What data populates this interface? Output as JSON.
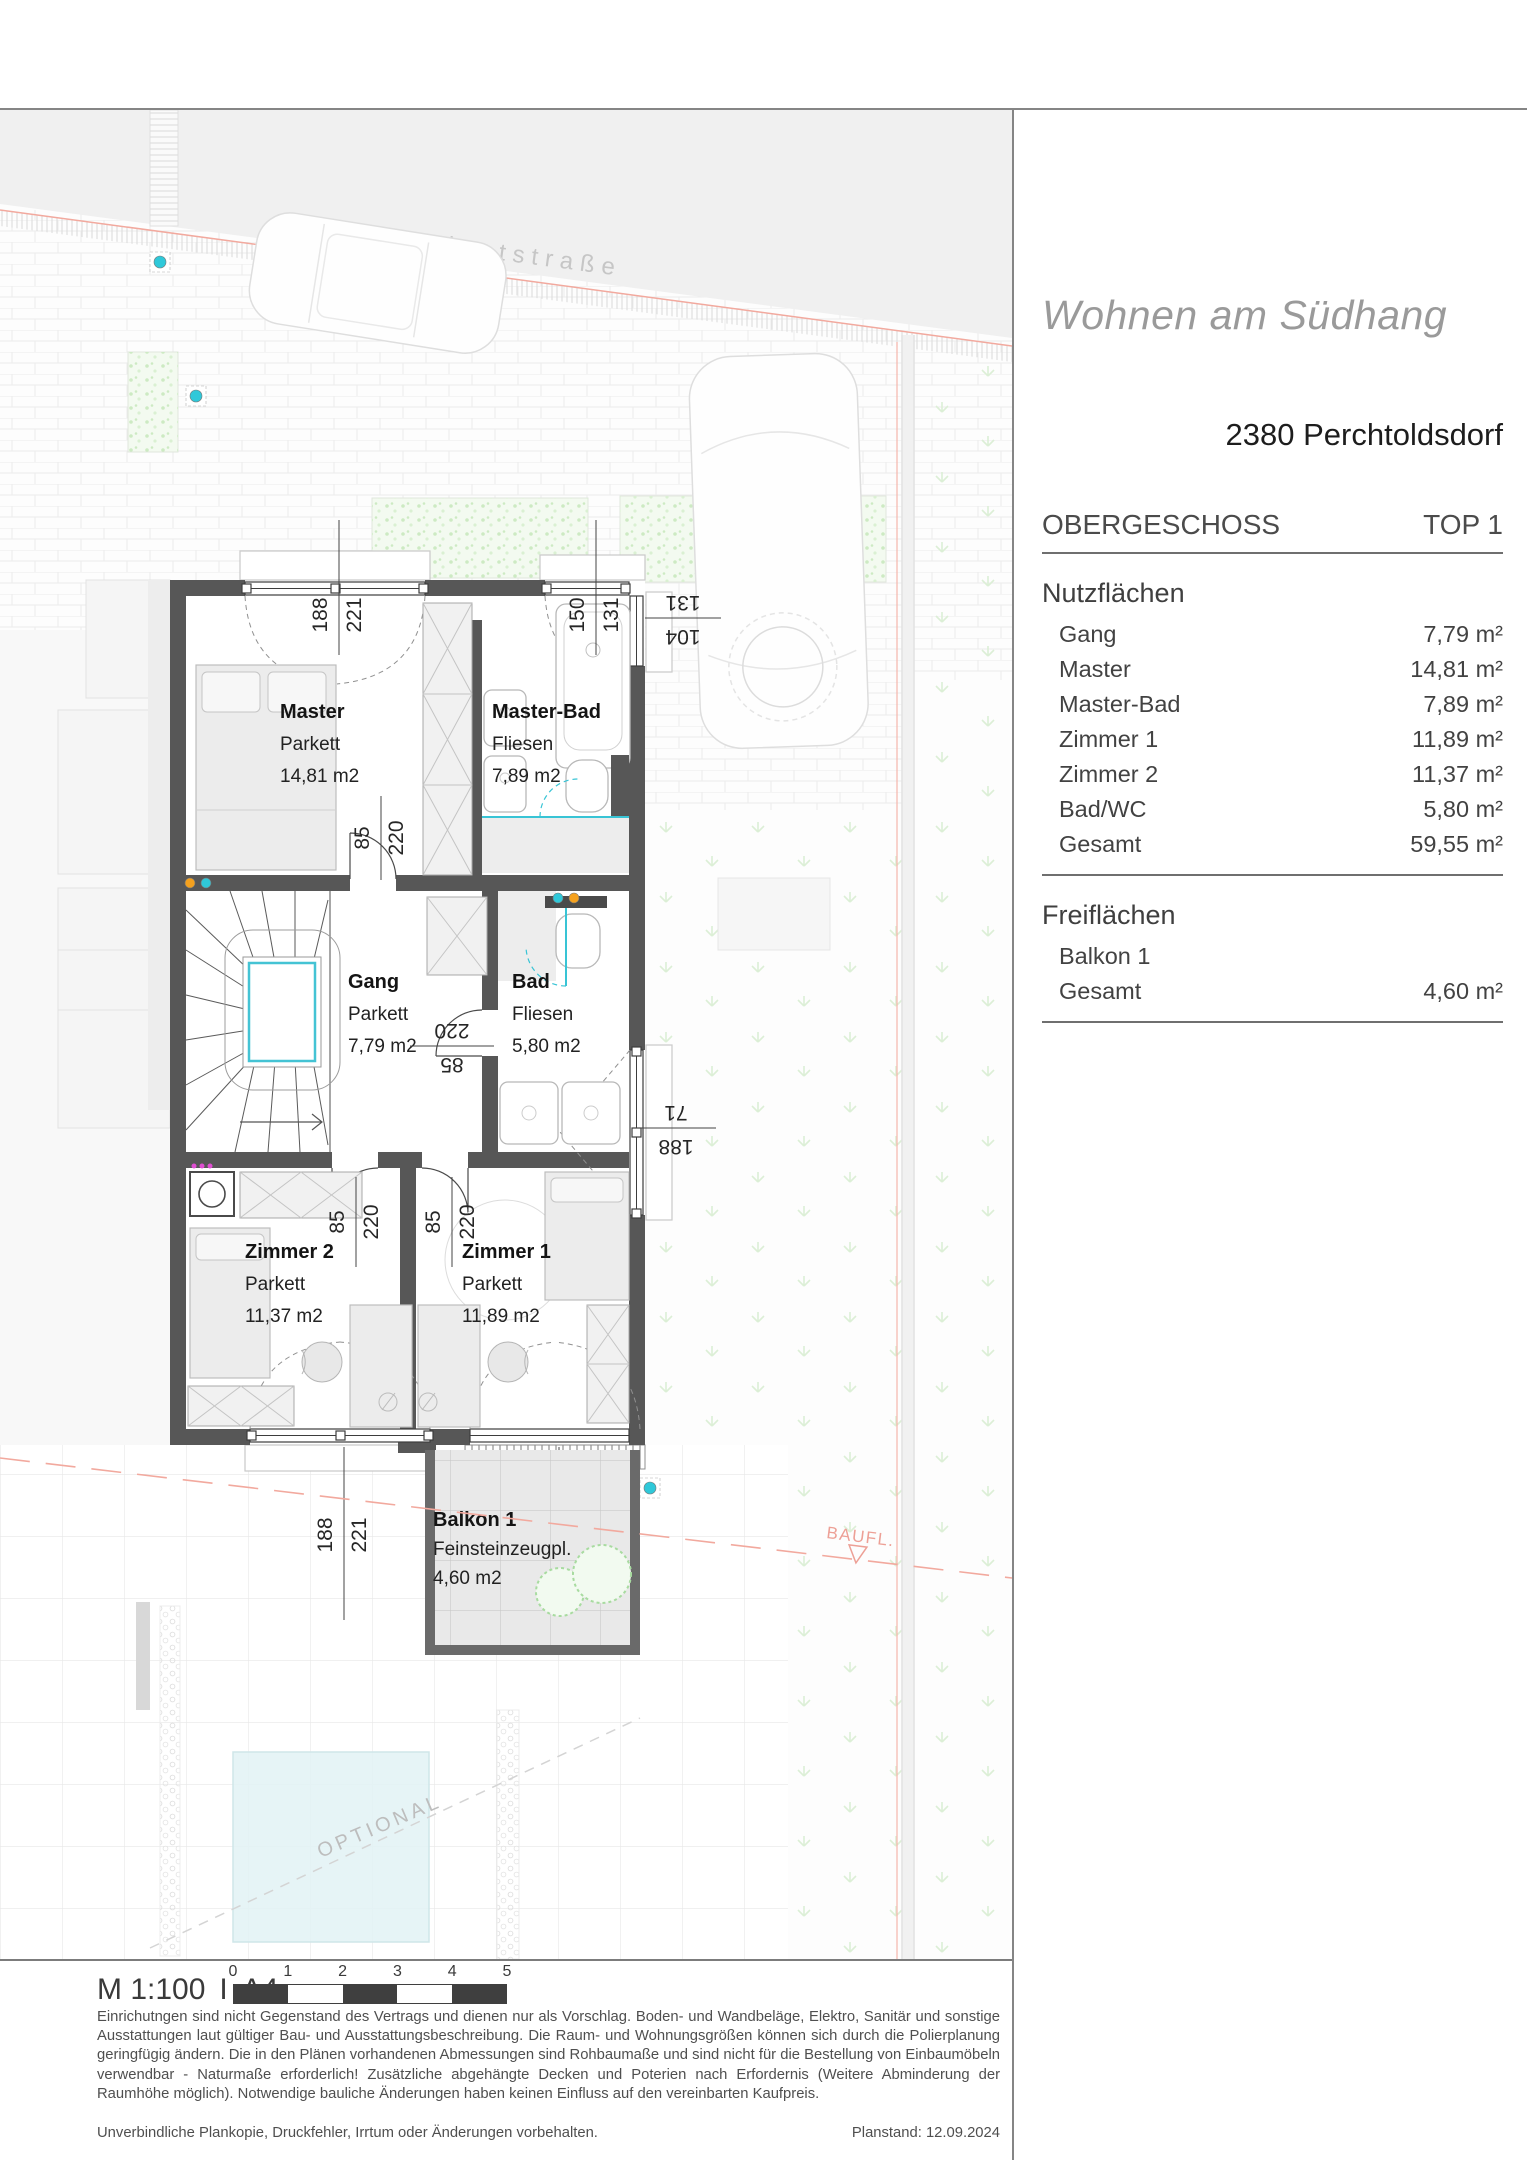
{
  "header": {
    "project_title": "Wohnen am Südhang",
    "address": "2380 Perchtoldsdorf",
    "floor_label": "OBERGESCHOSS",
    "unit_label": "TOP 1"
  },
  "nutzflaechen": {
    "title": "Nutzflächen",
    "rows": [
      {
        "label": "Gang",
        "value": "7,79 m²"
      },
      {
        "label": "Master",
        "value": "14,81 m²"
      },
      {
        "label": "Master-Bad",
        "value": "7,89 m²"
      },
      {
        "label": "Zimmer 1",
        "value": "11,89 m²"
      },
      {
        "label": "Zimmer 2",
        "value": "11,37 m²"
      },
      {
        "label": "Bad/WC",
        "value": "5,80 m²"
      },
      {
        "label": "Gesamt",
        "value": "59,55 m²"
      }
    ]
  },
  "freiflaechen": {
    "title": "Freiflächen",
    "rows": [
      {
        "label": "Balkon 1",
        "value": ""
      },
      {
        "label": "Gesamt",
        "value": "4,60 m²"
      }
    ]
  },
  "plan": {
    "street_label": "Privatstraße",
    "baufl_label": "BAUFL.",
    "optional_label": "OPTIONAL",
    "rooms": {
      "master": {
        "name": "Master",
        "floor": "Parkett",
        "area": "14,81 m2"
      },
      "master_bad": {
        "name": "Master-Bad",
        "floor": "Fliesen",
        "area": "7,89 m2"
      },
      "gang": {
        "name": "Gang",
        "floor": "Parkett",
        "area": "7,79 m2"
      },
      "bad": {
        "name": "Bad",
        "floor": "Fliesen",
        "area": "5,80 m2"
      },
      "zimmer2": {
        "name": "Zimmer 2",
        "floor": "Parkett",
        "area": "11,37 m2"
      },
      "zimmer1": {
        "name": "Zimmer 1",
        "floor": "Parkett",
        "area": "11,89 m2"
      },
      "balkon": {
        "name": "Balkon 1",
        "floor": "Feinsteinzeugpl.",
        "area": "4,60 m2"
      }
    },
    "dims": {
      "master_window": {
        "a": "188",
        "b": "221"
      },
      "mbad_window": {
        "a": "150",
        "b": "131"
      },
      "mbad_side": {
        "a": "104",
        "b": "131"
      },
      "master_door": {
        "a": "85",
        "b": "220"
      },
      "bad_door": {
        "a": "85",
        "b": "220"
      },
      "z2_door": {
        "a": "85",
        "b": "220"
      },
      "z1_door": {
        "a": "85",
        "b": "220"
      },
      "bad_window": {
        "a": "188",
        "b": "71"
      },
      "z2_window": {
        "a": "188",
        "b": "221"
      },
      "z1_window": {
        "a": "188",
        "b": "221"
      }
    }
  },
  "footer": {
    "scale_label": "M 1:100",
    "scale_sep": "I",
    "format_label": "A4",
    "scalebar_ticks": [
      "0",
      "1",
      "2",
      "3",
      "4",
      "5"
    ],
    "disclaimer": "Einrichutngen sind nicht Gegenstand des Vertrags und dienen nur als Vorschlag. Boden- und Wandbeläge, Elektro, Sanitär und sonstige Ausstattungen laut gültiger Bau- und Ausstattungsbeschreibung. Die Raum- und Wohnungsgrößen können sich durch die Polierplanung geringfügig ändern. Die in den Plänen vorhandenen Abmessungen sind Rohbaumaße und sind nicht für die Bestellung von Einbaumöbeln verwendbar - Naturmaße erforderlich! Zusätzliche abgehängte Decken und Poterien nach Erfordernis (Weitere Abminderung der Raumhöhe möglich). Notwendige bauliche Änderungen haben keinen Einfluss auf den vereinbarten Kaufpreis.",
    "note": "Unverbindliche Plankopie, Druckfehler, Irrtum oder Änderungen vorbehalten.",
    "planstand": "Planstand: 12.09.2024"
  },
  "colors": {
    "wall": "#575757",
    "boundary_red": "#f2a99e",
    "accent_cyan": "#2fc8d9",
    "accent_orange": "#f5a11e",
    "plant_green": "#cdeac3"
  }
}
